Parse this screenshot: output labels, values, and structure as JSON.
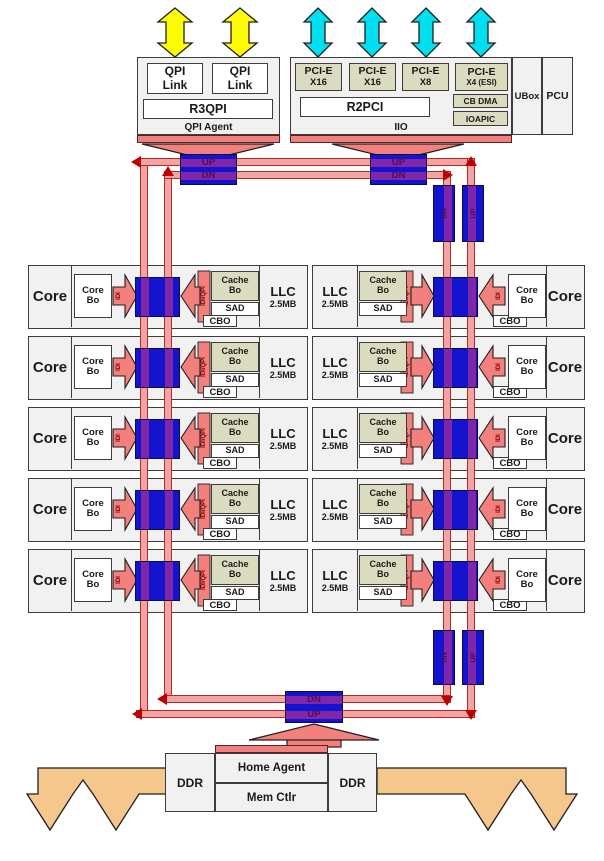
{
  "top": {
    "qpi_link_1": "QPI\nLink",
    "qpi_link_2": "QPI\nLink",
    "r3qpi": "R3QPI",
    "qpi_agent_caption": "QPI Agent",
    "pcie_slots": [
      {
        "name": "PCI-E",
        "width": "X16"
      },
      {
        "name": "PCI-E",
        "width": "X16"
      },
      {
        "name": "PCI-E",
        "width": "X8"
      },
      {
        "name": "PCI-E",
        "width": "X4 (ESI)"
      }
    ],
    "cb_dma": "CB DMA",
    "ioapic": "IOAPIC",
    "r2pci": "R2PCI",
    "iio_caption": "IIO",
    "ubox": "UBox",
    "pcu": "PCU"
  },
  "ring": {
    "up": "UP",
    "dn": "DN"
  },
  "row_labels": {
    "core": "Core",
    "core_bo": "Core\nBo",
    "idi": "IDI",
    "idi_qpi": "IDI/QPI",
    "cache_bo": "Cache\nBo",
    "sad": "SAD",
    "cbo": "CBO",
    "llc": "LLC",
    "llc_size": "2.5MB"
  },
  "rows": {
    "left_count": 5,
    "right_count": 5
  },
  "bottom": {
    "home_agent": "Home Agent",
    "mem_ctlr": "Mem Ctlr",
    "ddr_left": "DDR",
    "ddr_right": "DDR"
  },
  "colors": {
    "ring_pink": "#F2A3A3",
    "ring_border": "#b52828",
    "ring_stop_blue": "#1414CE",
    "stop_stripe_purple": "#8026a8",
    "arrow_salmon": "#F3807C",
    "pcie_khaki": "#DBDBC0",
    "qpi_arrow_yellow": "#FDFD00",
    "pcie_arrow_cyan": "#00DFF0",
    "ddr_arrow_orange": "#F6C78D",
    "box_gray": "#F1F1F1",
    "direction_arrow_red": "#C00000"
  }
}
